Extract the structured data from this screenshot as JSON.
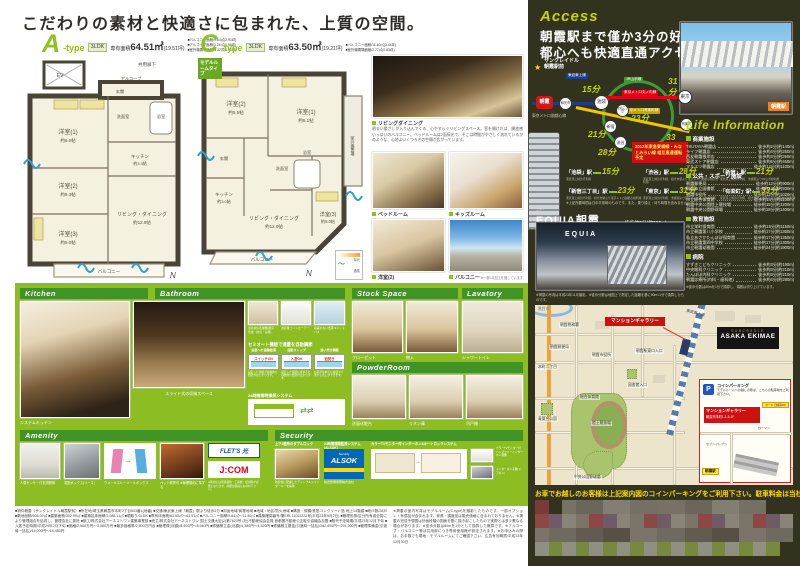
{
  "colors": {
    "accent_green": "#8cbd22",
    "bar_green": "#3f9425",
    "type_green": "#8dc21f",
    "lime": "#c3d600",
    "dark_bg": "#32321e",
    "red": "#cc1111",
    "alsok_blue": "#0068b7",
    "jcom_red": "#e60012",
    "map_bg": "#ece4cb",
    "note_yellow": "#ffdd00"
  },
  "page_title": "こだわりの素材と快適さに包まれた、上質の空間。",
  "plan_a": {
    "letter": "A",
    "suffix": "-type",
    "layout": "3LDK",
    "area_label": "専有面積",
    "area_value": "64.51㎡",
    "area_tsubo": "(19.51坪)",
    "notes": [
      "■バルコニー面積/9.64㎡(2.91坪)",
      "■アルコーブ面積/3.24㎡(0.98坪)",
      "■室外機置場面積/3.32㎡(1.00坪)"
    ],
    "corridor": "共用廊下",
    "ev": "EV",
    "alcove": "アルコーブ",
    "genkan": "玄関",
    "r1": "洋室(1)",
    "r1s": "約6.0帖",
    "r2": "洋室(2)",
    "r2s": "約5.3帖",
    "r3": "洋室(3)",
    "r3s": "約5.0帖",
    "ld": "リビング・ダイニング",
    "lds": "約12.9帖",
    "k": "キッチン",
    "ks": "約3.3帖",
    "bath": "浴室",
    "wash": "洗面室",
    "balcony": "バルコニー",
    "compass": "N"
  },
  "plan_c": {
    "letter": "C",
    "suffix": "-type",
    "layout": "3LDK",
    "area_label": "専有面積",
    "area_value": "63.50㎡",
    "area_tsubo": "(19.21坪)",
    "notes": [
      "■バルコニー面積/11.40㎡(3.44坪)",
      "■室外機置場面積/2.77㎡(0.83坪)"
    ],
    "model_tag": "モデルルームタイプ",
    "r1": "洋室(1)",
    "r1s": "約6.1帖",
    "r2": "洋室(2)",
    "r2s": "約5.5帖",
    "r3": "洋室(3)",
    "r3s": "約5.0帖",
    "ld": "リビング・ダイニング",
    "lds": "約12.0帖",
    "k": "キッチン",
    "ks": "約3.0帖",
    "bath": "浴室",
    "wash": "洗面室",
    "genkan": "玄関",
    "balcony": "バルコニー",
    "outdoor": "室外機置場",
    "legend_light": "採光",
    "legend_wind": "通風",
    "compass": "N"
  },
  "photos": {
    "living_label": "リビングダイニング",
    "living_text": "明るい陽ざしが入り込んでくる、心やすらぐリビングスペース。窓を開ければ、開放感いっぱいのバルコニー。ベッドルームは2面採光で、そこは時間がやさしく流れているかのような、心地よいくつろぎの空間が広がっています。",
    "items": [
      "ベッドルーム",
      "キッズルーム",
      "洋室(2)",
      "バルコニー"
    ],
    "cg_note": "※一部CG加工を施しています"
  },
  "kitchen": {
    "title": "Kitchen",
    "cap1": "システムキッチン",
    "cap2": "スライド式の収納スペース"
  },
  "bathroom": {
    "title": "Bathroom",
    "tiles": [
      "浴室換気乾燥機(暖房・乾燥・換気・涼風)",
      "浴室用コントローラー",
      "段差のない低床ユニットバス"
    ],
    "semi_title": "セミオート機能で湯量を自動調節",
    "steps": [
      {
        "h": "浴室への自動給湯",
        "tub": "スイッチON",
        "d": "設定した湯量で自動的に給湯がはじまります。"
      },
      {
        "h": "自動ストップ",
        "tub": "入浴OK",
        "d": "設定した湯量に達すると自動的に給湯が止まります。"
      },
      {
        "h": "追い焚き機能",
        "tub": "追焚き",
        "d": "お湯が冷めても適温まで沸かし直しができます。"
      }
    ],
    "vent_title": "24時間常時換気システム"
  },
  "stock": {
    "title": "Stock Space",
    "cap1": "クローゼット",
    "cap2": "物入"
  },
  "lavatory": {
    "title": "Lavatory",
    "cap": "シャワートイレ"
  },
  "powder": {
    "title": "PowderRoom",
    "caps": [
      "洗面化粧台",
      "リネン庫",
      "吊戸棚"
    ]
  },
  "amenity": {
    "title": "Amenity",
    "caps": [
      "人感センサー付玄関照明",
      "宅配ボックス(リース)",
      "ウォールスルーメールボックス",
      "ペット飼育可 ※管理規約に準ずる"
    ],
    "flets": "FLET'S 光",
    "flets_note": "※フレッツ光対応",
    "jcom": "J:COM",
    "jcom_sub": "CATV配線済み",
    "note": "※利用には別途契約・工事費・使用料が必要となります。詳細は係員にお尋ね下さい。"
  },
  "security": {
    "title": "Security",
    "lock_title": "上下2箇所のダブルロック",
    "lock_cap": "防犯性に配慮したディンプルシリンダーキーを採用",
    "alsok_title": "24時間遠隔監視システム(ALSOK)",
    "alsok_logo": "ALSOK",
    "alsok_tag": "Security",
    "alsok_sub": "綜合警備保障株式会社",
    "sys_title": "カラーTVモニター付インターホン&オートロックシステム",
    "mon_cap": "カラーTVモニター付ハンズフリーインターホン親機",
    "door_cap": "インターホン子機(ドアホン)"
  },
  "legal": {
    "col1": "■物件概要〈サンクレイドル朝霞駅前〉■所在地/埼玉県朝霞市本町2丁目503番1(地番) ■交通/東武東上線「朝霞」駅より徒歩3分 ■用途地域/商業地域 ■地域・地区/防火地域 ■構造・規模/鉄筋コンクリート造 地上14階建 ■総戸数/28戸 ■敷地面積/506.09㎡ ■建築面積/302.99㎡ ■建築延床面積/2,088.11㎡ ■間取り/3LDK ■専有床面積/63.50㎡〜64.51㎡ ■バルコニー面積/9.64㎡〜11.40㎡ ■建築確認番号/第ERI-11022222号(平成23年5月2日) ■管理形態/区分所有者全員により管理組合を結成し、管理会社に委託 ■施工/株式会社アーネストワン建築事業部 ■売主/株式会社アーネストワン 国土交通大臣(2)第7620号 (社)不動産協会会員 首都圏不動産公正取引協議会加盟 ■販売予定時期/平成23年12月下旬 ■入居予定時期/平成24年2月下旬 ■価格/2,580万円〜3,080万円 ■最多価格帯/2,800万円台 ■管理費(月額)/8,400円〜8,540円 ■修繕積立金(月額)/4,380円〜4,520円 ■修繕積立基金(引渡時一括払)/282,800円〜291,200円 ■管理準備金(引渡時一括払)/14,000円〜14,450円",
    "col2": "※掲載の室内写真はモデルルーム(C-type)を撮影したものです。一部オプション・有償品が含まれます。家具・調度品は販売価格に含まれておりません。※掲載の完成予想図は計画段階の図面を基に描き起こしたもので実際とは多少異なる場合があります。※徒歩分数は80mを1分として換算した概算です。※アルコーブ・バルコニー等は共用部につき専用使用権が設定されます。※お申込みの際は、お手数でも現地・モデルルームにてご確認下さい。広告有効期限/平成23年12月30日"
  },
  "access": {
    "title": "Access",
    "headline1": "朝霞駅まで僅か3分の好立地",
    "headline2": "都心へも快適直通アクセス",
    "building_name1": "サンクレイドル",
    "building_name2": "朝霞駅前",
    "line_tobu": "東武東上線",
    "line_yamanote": "JR山手線",
    "line_marunouchi": "東京メトロ丸ノ内線",
    "line_yurakucho": "東京メトロ有楽町線",
    "line_fukutoshin": "東京メトロ副都心線",
    "st_asaka": "朝霞",
    "st_wako": "和光市",
    "st_ikebukuro": "池袋",
    "st_shinjuku": "新宿",
    "st_shinjuku3": "新宿三丁目",
    "st_shibuya": "渋谷",
    "st_tokyo": "東京",
    "st_yurakucho": "有楽町",
    "m_ikebukuro": "15分",
    "m_shinjuku": "21分",
    "m_shinjuku3": "23分",
    "m_shibuya": "28分",
    "m_tokyo": "31分",
    "m_yurakucho": "33分",
    "future_note": "2012年東急東横線・みなとみらい線 相互直通運転予定",
    "station_photo_label": "朝霞駅",
    "table": [
      {
        "name": "「池袋」駅",
        "min": "15分",
        "via": "東武東上線急行利用"
      },
      {
        "name": "「渋谷」駅",
        "min": "28分",
        "via": "東武東上線急行利用、和光市駅より東京メトロ副都心線急行利用"
      },
      {
        "name": "「新宿」駅",
        "min": "21分",
        "via": "東武東上線急行利用、池袋駅よりJR山手線利用"
      },
      {
        "name": "「新宿三丁目」駅",
        "min": "23分",
        "via": "東武東上線急行利用、和光市駅より東京メトロ副都心線利用"
      },
      {
        "name": "「東京」駅",
        "min": "31分",
        "via": "東武東上線急行利用、池袋駅より東京メトロ丸ノ内線利用"
      },
      {
        "name": "「有楽町」駅",
        "min": "33分",
        "via": "東武東上線急行利用、和光市駅より東京メトロ有楽町線利用"
      }
    ],
    "time_note": "※上記所要時間は日中平常時のものです。また、乗り換え・待ち時間を含みません。",
    "equia_ruby": "エキア",
    "equia_name": "EQUIA朝霞",
    "equia_walk": "徒歩約3分(約200m)",
    "equia_sign": "EQUIA",
    "photo_note": "※掲載の写真は平成23年11月撮影。※徒歩分数は地図上で測定した距離を基に80m=1分で換算したものです。"
  },
  "life": {
    "title": "Life Information",
    "categories": [
      {
        "name": "商業施設",
        "items": [
          [
            "TSUTAYA朝霞店",
            "徒歩約2分(約140m)"
          ],
          [
            "ライフ朝霞店",
            "徒歩約4分(約250m)"
          ],
          [
            "西友朝霞根岸店",
            "徒歩約4分(約260m)"
          ],
          [
            "東武ストア朝霞店",
            "徒歩約6分(約450m)"
          ],
          [
            "マルエツ朝霞店",
            "徒歩約14分(約1100m)"
          ]
        ]
      },
      {
        "name": "公共・スポーツ施設",
        "items": [
          [
            "朝霞郵便局",
            "徒歩約12分(約900m)"
          ],
          [
            "朝霞市立図書館",
            "徒歩約12分(約930m)"
          ],
          [
            "朝霞市役所",
            "徒歩約13分(約1020m)"
          ],
          [
            "市立総合体育館",
            "徒歩約14分(約1100m)"
          ],
          [
            "朝霞中央公園陸上競技場",
            "徒歩約15分(約1200m)"
          ],
          [
            "朝霞中央公園野球場",
            "徒歩約18分(約1400m)"
          ]
        ]
      },
      {
        "name": "教育施設",
        "items": [
          [
            "市立栄町保育園",
            "徒歩約15分(約1150m)"
          ],
          [
            "市立朝霞第八小学校",
            "徒歩約17分(約1350m)"
          ],
          [
            "私立あさかたんぽぽ保育園",
            "徒歩約17分(約1350m)"
          ],
          [
            "市立朝霞第四中学校",
            "徒歩約17分(約1300m)"
          ],
          [
            "市立朝霞幼稚園",
            "徒歩約24分(約1900m)"
          ]
        ]
      },
      {
        "name": "病院",
        "items": [
          [
            "すずきこどもクリニック",
            "徒歩約3分(約190m)"
          ],
          [
            "中央眼科クリニック",
            "徒歩約3分(約210m)"
          ],
          [
            "たんぽぽ内科クリニック",
            "徒歩約3分(約210m)"
          ],
          [
            "朝霞診療所(内科・歯科他)",
            "徒歩約4分(約280m)"
          ]
        ]
      }
    ],
    "note": "※徒歩分数は80mを1分で換算し、端数は切り上げています。"
  },
  "map": {
    "gallery_label": "マンションギャラリー",
    "brand_top": "SUNCRADLE",
    "brand_main": "ASAKA EKIMAE",
    "labels": [
      "朝霞市役所",
      "朝霞郵便局",
      "総合体育館",
      "陸上競技場",
      "中央公園野球場",
      "青葉台公園",
      "図書館入口",
      "朝霞税務署",
      "本町二丁目",
      "朝霞駅東口入口",
      "東武東上線",
      "黒目川"
    ],
    "inset_parking": "コインパーキング",
    "inset_text": "モデルルームへお越しの際は、こちらの駐車場をご利用下さい。",
    "inset_card": "カードで精算OK",
    "inset_gallery": "マンションギャラリー",
    "inset_address": "朝霞市本町1-1-5-1F",
    "inset_conv1": "ローソン",
    "inset_conv2": "セブンイレブン",
    "inset_east": "東口",
    "inset_station": "朝霞駅",
    "car_note": "お車でお越しのお客様は上記案内図のコインパーキングをご利用下さい。駐車料金は当社で負担致します。"
  }
}
